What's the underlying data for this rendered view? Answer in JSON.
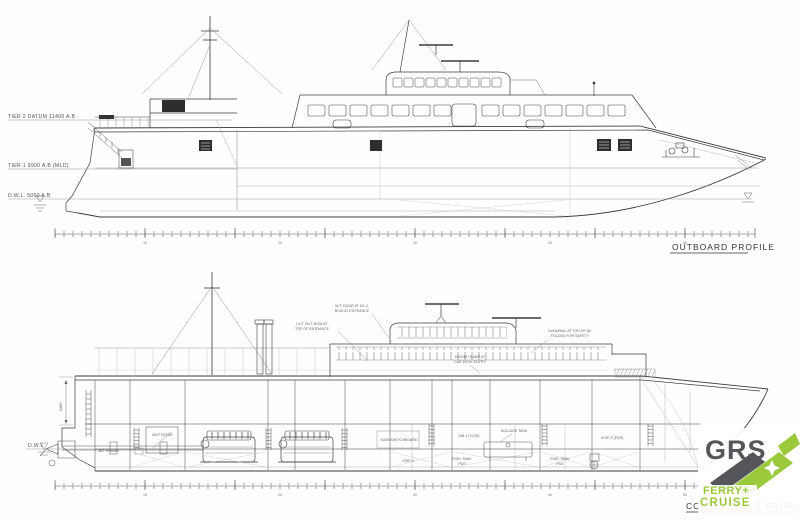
{
  "titles": {
    "outboard": "OUTBOARD PROFILE",
    "compartment": "COMPARTMENT PROFILE"
  },
  "datum_labels": {
    "tier2": "TIER 2 DATUM 11400 A.B",
    "tier1": "TIER 1 9900 A.B (MLD)",
    "dwl": "D.W.L. 5060 A.B",
    "dwl_lower": "D.W.L"
  },
  "dimensions": {
    "depth": "3400"
  },
  "frames": {
    "f1": "10",
    "f2": "20",
    "f3": "30",
    "f4": "40",
    "f5": "50"
  },
  "callouts": {
    "c1_line1": "W.T. DOOR AT DK 2,",
    "c1_line2": "BOW AT ENTRANCE",
    "c2_line1": "CUT OUT, BOW AT",
    "c2_line2": "TOP OF ENTRANCE",
    "c3_line1": "HANDRAIL AT TOP OF DK",
    "c3_line2": "FOLDED FOR SAFETY",
    "c4_line1": "HINGED RAMP AT",
    "c4_line2": "CAR DECK ENTRY"
  },
  "compartments": {
    "jet_room": "JET ROOM",
    "unit_room": "UNIT ROOM",
    "switchboard": "MAIN SWITCHBOARD",
    "wb1": "WB 1 (VOID)",
    "sullage": "SULLAGE TANK",
    "void2": "VOID 2 (P&S)",
    "void4": "VOID 4",
    "fuel1_line1": "FUEL TANK",
    "fuel1_line2": "P&S",
    "fuel2_line1": "FUEL TANK",
    "fuel2_line2": "P&S"
  },
  "logo": {
    "brand": "GRS",
    "line1": "FERRY+",
    "line2": "CRUISE",
    "brand_color": "#54565a",
    "accent_green": "#9aca3c"
  }
}
